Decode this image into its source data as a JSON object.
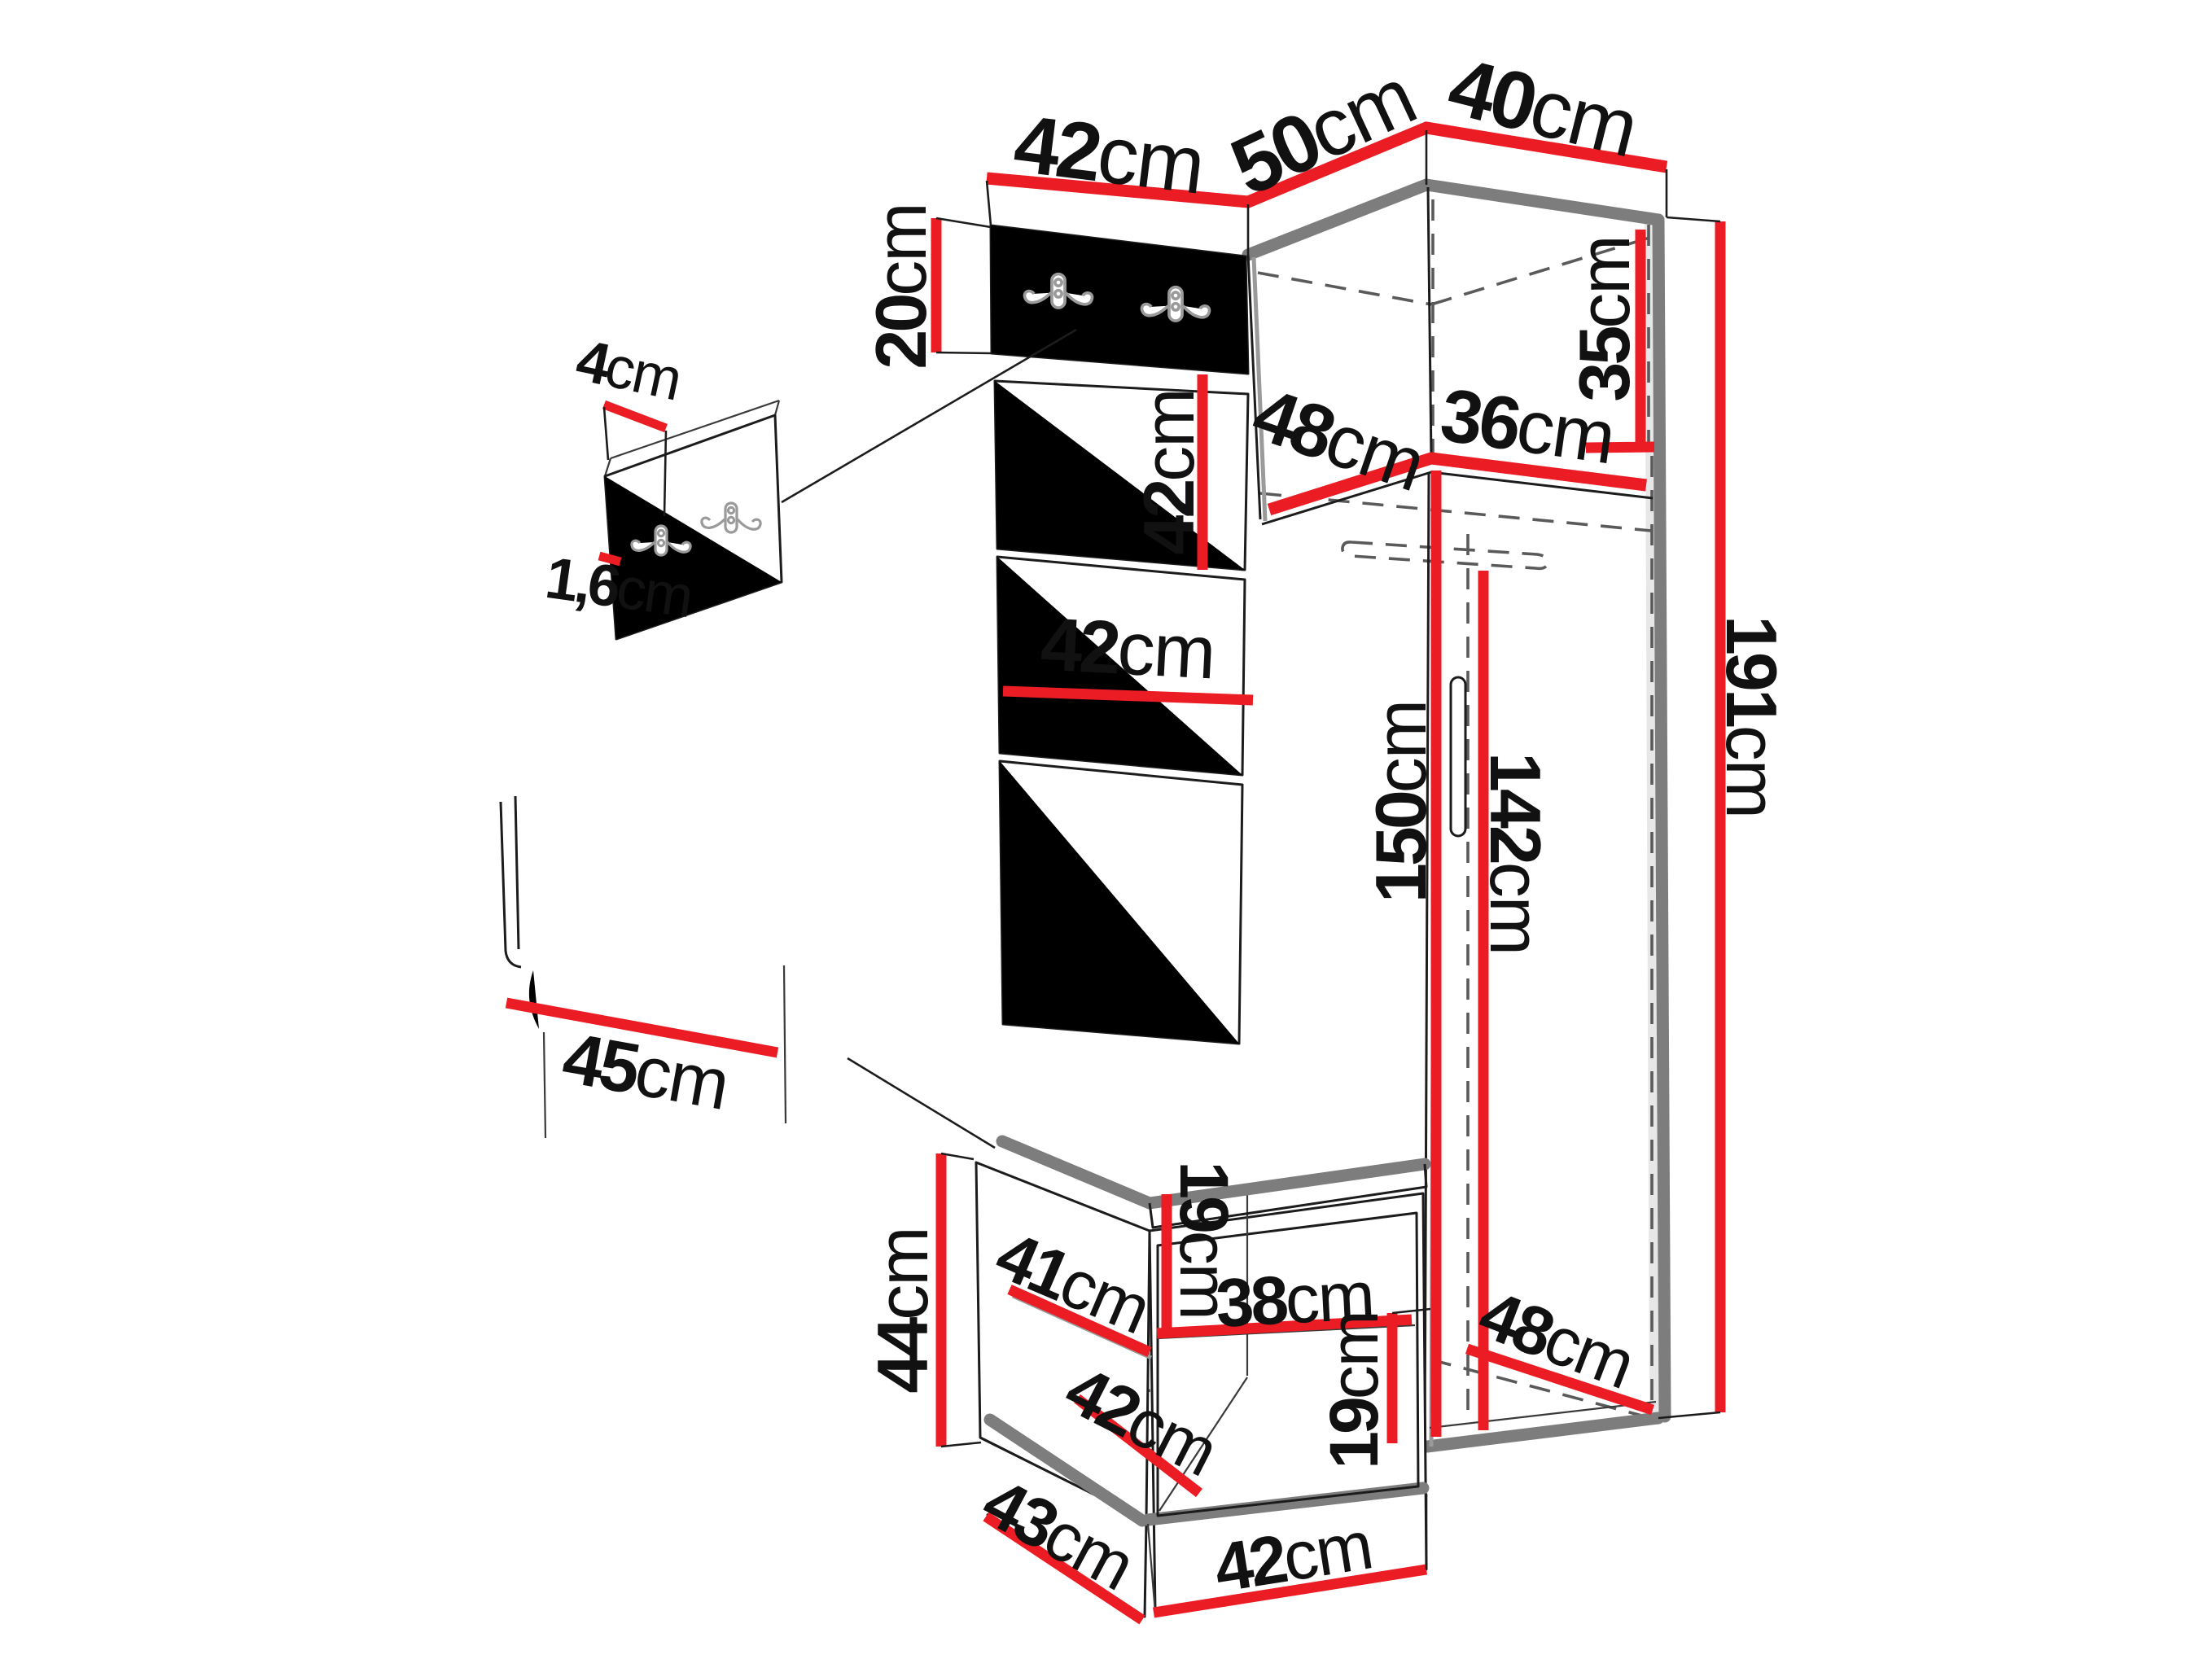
{
  "diagram": {
    "type": "furniture-dimension-diagram",
    "subject": "Hallway furniture set: corner wardrobe with upholstered panel column, wall hook boards and shoe bench, shown with dimension callouts",
    "unit": "cm",
    "colors": {
      "dimension_line": "#EC1C24",
      "furniture_outline": "#7d7d7d",
      "hidden_edge": "#5a5a5a",
      "label_text": "#111111",
      "background": "#ffffff"
    }
  },
  "labels": [
    {
      "id": "top-depth-left",
      "value": "42",
      "unit": "cm"
    },
    {
      "id": "top-width-middle",
      "value": "50",
      "unit": "cm"
    },
    {
      "id": "top-width-right",
      "value": "40",
      "unit": "cm"
    },
    {
      "id": "hook-board-height",
      "value": "20",
      "unit": "cm"
    },
    {
      "id": "hook-board-depth",
      "value": "4",
      "unit": "cm"
    },
    {
      "id": "hook-board-thickness",
      "value": "1,6",
      "unit": "cm"
    },
    {
      "id": "panel-height",
      "value": "42",
      "unit": "cm"
    },
    {
      "id": "niche-depth",
      "value": "48",
      "unit": "cm"
    },
    {
      "id": "niche-width",
      "value": "36",
      "unit": "cm"
    },
    {
      "id": "niche-height",
      "value": "35",
      "unit": "cm"
    },
    {
      "id": "panel-width",
      "value": "42",
      "unit": "cm"
    },
    {
      "id": "interior-height-left",
      "value": "150",
      "unit": "cm"
    },
    {
      "id": "interior-height-right",
      "value": "142",
      "unit": "cm"
    },
    {
      "id": "total-height",
      "value": "191",
      "unit": "cm"
    },
    {
      "id": "seat-depth-detail",
      "value": "45",
      "unit": "cm"
    },
    {
      "id": "bench-height",
      "value": "44",
      "unit": "cm"
    },
    {
      "id": "bench-shelf-depth",
      "value": "41",
      "unit": "cm"
    },
    {
      "id": "bench-opening-upper",
      "value": "19",
      "unit": "cm"
    },
    {
      "id": "bench-shelf-width",
      "value": "38",
      "unit": "cm"
    },
    {
      "id": "bench-opening-lower",
      "value": "19",
      "unit": "cm"
    },
    {
      "id": "bench-inner-depth",
      "value": "42",
      "unit": "cm"
    },
    {
      "id": "wardrobe-bottom-width",
      "value": "48",
      "unit": "cm"
    },
    {
      "id": "bench-base-depth",
      "value": "43",
      "unit": "cm"
    },
    {
      "id": "bench-base-width",
      "value": "42",
      "unit": "cm"
    }
  ]
}
